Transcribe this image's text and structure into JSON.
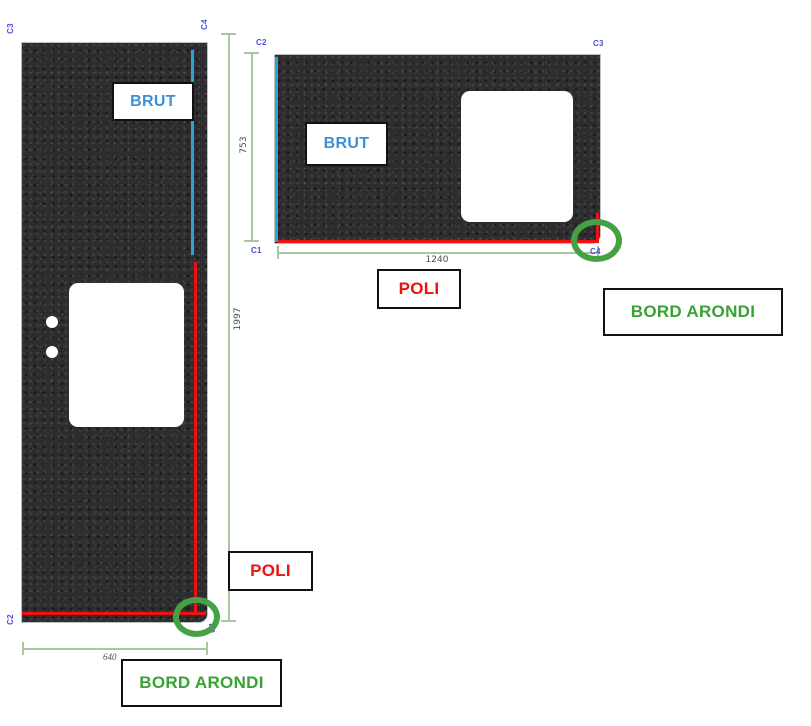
{
  "diagram_type": "stone-cutting-plan",
  "pieces": {
    "left": {
      "corners": {
        "top_left": "C3",
        "top_right": "C4",
        "bottom_left": "C2",
        "bottom_right": "C1"
      },
      "edge_labels": {
        "brut": "BRUT",
        "poli": "POLI",
        "bord_arondi": "BORD ARONDI"
      },
      "dimensions": {
        "height": "1997",
        "width": "640"
      },
      "features": {
        "cutout": "rectangular-cutout",
        "holes": "2-drill-holes",
        "highlight": "rounded-corner-highlight"
      }
    },
    "right": {
      "corners": {
        "top_left": "C2",
        "top_right": "C3",
        "bottom_left": "C1",
        "bottom_right": "C4"
      },
      "edge_labels": {
        "brut": "BRUT",
        "poli": "POLI",
        "bord_arondi": "BORD ARONDI"
      },
      "dimensions": {
        "height": "753",
        "width": "1240"
      },
      "features": {
        "cutout": "rectangular-cutout",
        "highlight": "rounded-corner-highlight"
      }
    }
  },
  "colors": {
    "slab": "#2d2d2f",
    "raw_edge_blue": "#2ba2dc",
    "polished_edge_red": "#ee1111",
    "highlight_green": "#44a244",
    "corner_label_blue": "#4b4be0",
    "dimension_line_green": "#a9c6a1",
    "brut_text": "#3d8fd6",
    "poli_text": "#ee1111",
    "bord_arondi_text": "#38a233"
  }
}
